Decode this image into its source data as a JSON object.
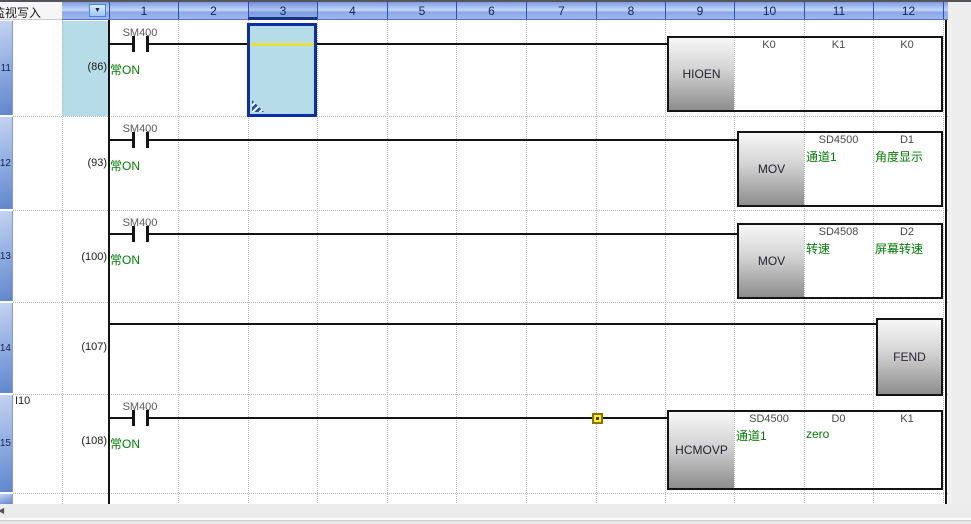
{
  "window": {
    "mode_label": "监视写入"
  },
  "header": {
    "columns": [
      "1",
      "2",
      "3",
      "4",
      "5",
      "6",
      "7",
      "8",
      "9",
      "10",
      "11",
      "12"
    ],
    "selected_column": "3"
  },
  "left_margin": {
    "rung_numbers": [
      "11",
      "12",
      "13",
      "14",
      "15"
    ]
  },
  "rungs": [
    {
      "step": "(86)",
      "contact_device": "SM400",
      "contact_comment": "常ON",
      "mnemonic": "HIOEN",
      "operands": [
        {
          "value": "K0",
          "comment": ""
        },
        {
          "value": "K1",
          "comment": ""
        },
        {
          "value": "K0",
          "comment": ""
        }
      ]
    },
    {
      "step": "(93)",
      "contact_device": "SM400",
      "contact_comment": "常ON",
      "mnemonic": "MOV",
      "operands": [
        {
          "value": "SD4500",
          "comment": "通道1"
        },
        {
          "value": "D1",
          "comment": "角度显示"
        }
      ]
    },
    {
      "step": "(100)",
      "contact_device": "SM400",
      "contact_comment": "常ON",
      "mnemonic": "MOV",
      "operands": [
        {
          "value": "SD4508",
          "comment": "转速"
        },
        {
          "value": "D2",
          "comment": "屏幕转速"
        }
      ]
    },
    {
      "step": "(107)",
      "mnemonic": "FEND",
      "operands": []
    },
    {
      "step": "(108)",
      "pointer": "I10",
      "contact_device": "SM400",
      "contact_comment": "常ON",
      "mnemonic": "HCMOVP",
      "operands": [
        {
          "value": "SD4500",
          "comment": "通道1"
        },
        {
          "value": "D0",
          "comment": "zero"
        },
        {
          "value": "K1",
          "comment": ""
        }
      ]
    }
  ],
  "icons": {
    "dropdown_arrow": "▼",
    "scroll_left": "◀"
  },
  "colors": {
    "selection_border": "#0c2ea6",
    "selection_fill": "#b6dce7",
    "comment_green": "#007d00",
    "wire_yellow": "#e8df3e",
    "header_blue": "#8ea8e8",
    "marker_yellow": "#ffee22"
  }
}
